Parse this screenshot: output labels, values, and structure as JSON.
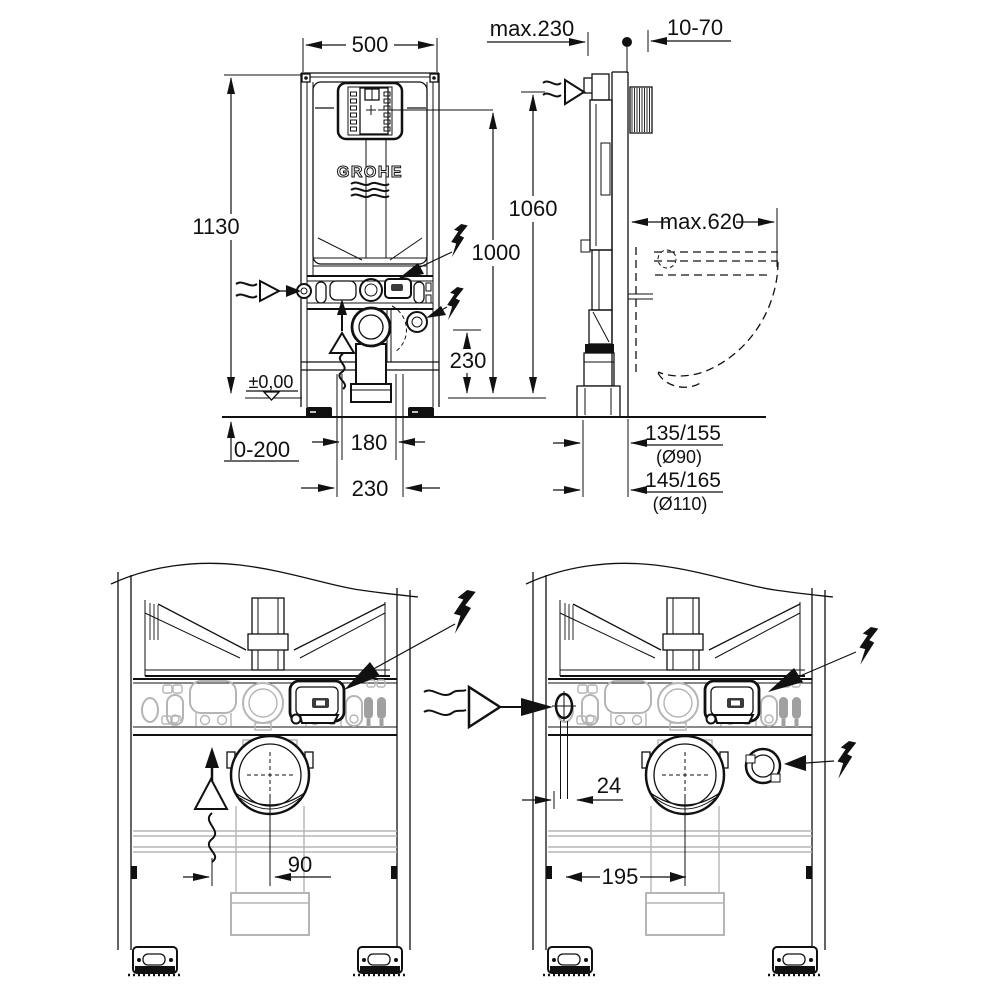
{
  "drawing": {
    "brand": "GROHE",
    "front_view": {
      "width": "500",
      "frame_height": "1130",
      "actuation_height": "1000",
      "supply_height": "1060",
      "outlet_height": "230",
      "floor_level": "±0,00",
      "floor_buildup": "0-200",
      "outlet_offset": "180",
      "recess_width": "230"
    },
    "side_view": {
      "frame_depth": "max.230",
      "wall_clearance": "10-70",
      "bowl_depth": "max.620",
      "outlet_d90": "135/155",
      "outlet_d90_note": "(Ø90)",
      "outlet_d110": "145/165",
      "outlet_d110_note": "(Ø110)"
    },
    "detail_left": {
      "outlet_offset": "90"
    },
    "detail_right": {
      "supply_offset": "24",
      "socket_offset": "195"
    }
  }
}
